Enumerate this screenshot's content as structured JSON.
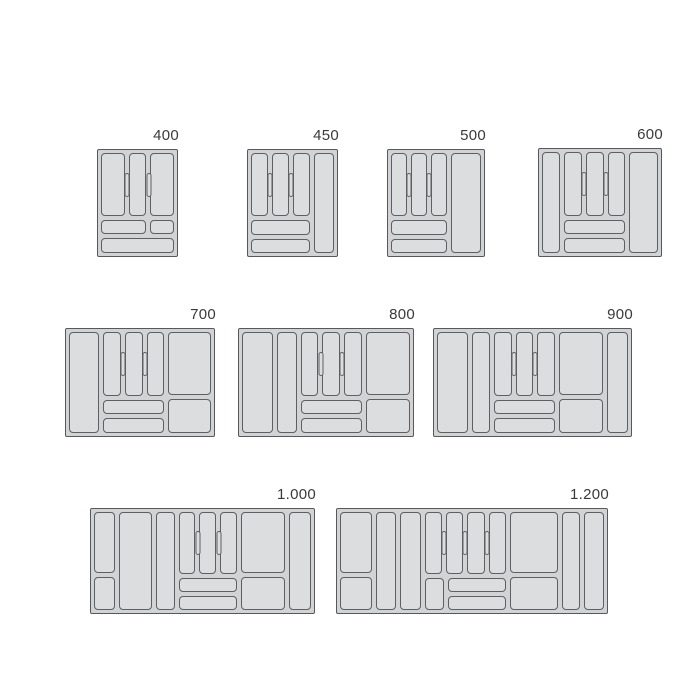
{
  "colors": {
    "background": "#ffffff",
    "tray_base": "#d2d3d5",
    "compartment_fill": "#dcddde",
    "outline": "#56585c",
    "compartment_outline": "#5d5f63",
    "label_text": "#3a3a3c"
  },
  "trays": [
    {
      "label": "400",
      "x": 97,
      "y": 149,
      "w": 81,
      "h": 108,
      "columns": [
        {
          "type": "cutlery",
          "flex": 69,
          "verticals": [
            23,
            17,
            23
          ],
          "pills": 2,
          "bottom": "split_then_full"
        }
      ]
    },
    {
      "label": "450",
      "x": 247,
      "y": 149,
      "w": 91,
      "h": 108,
      "columns": [
        {
          "type": "cutlery",
          "flex": 60,
          "verticals": [
            1,
            1,
            1
          ],
          "pills": 2,
          "bottom": "rows"
        },
        {
          "type": "tall",
          "flex": 20
        }
      ]
    },
    {
      "label": "500",
      "x": 387,
      "y": 149,
      "w": 98,
      "h": 108,
      "columns": [
        {
          "type": "cutlery",
          "flex": 55,
          "verticals": [
            1,
            1,
            1
          ],
          "pills": 2,
          "bottom": "rows"
        },
        {
          "type": "tall",
          "flex": 30
        }
      ]
    },
    {
      "label": "600",
      "x": 538,
      "y": 148,
      "w": 124,
      "h": 109,
      "columns": [
        {
          "type": "tall",
          "flex": 18
        },
        {
          "type": "cutlery",
          "flex": 60,
          "verticals": [
            1,
            1,
            1
          ],
          "pills": 2,
          "bottom": "rows"
        },
        {
          "type": "tall",
          "flex": 28
        }
      ]
    },
    {
      "label": "700",
      "x": 65,
      "y": 328,
      "w": 150,
      "h": 109,
      "columns": [
        {
          "type": "tall",
          "flex": 30
        },
        {
          "type": "cutlery",
          "flex": 60,
          "verticals": [
            1,
            1,
            1
          ],
          "pills": 2,
          "bottom": "rows"
        },
        {
          "type": "split",
          "flex": 42
        }
      ]
    },
    {
      "label": "800",
      "x": 238,
      "y": 328,
      "w": 176,
      "h": 109,
      "columns": [
        {
          "type": "tall",
          "flex": 30
        },
        {
          "type": "tall",
          "flex": 19
        },
        {
          "type": "cutlery",
          "flex": 59,
          "verticals": [
            1,
            1,
            1
          ],
          "pills": 2,
          "bottom": "rows"
        },
        {
          "type": "split",
          "flex": 43
        }
      ]
    },
    {
      "label": "900",
      "x": 433,
      "y": 328,
      "w": 199,
      "h": 109,
      "columns": [
        {
          "type": "tall",
          "flex": 30
        },
        {
          "type": "tall",
          "flex": 18
        },
        {
          "type": "cutlery",
          "flex": 60,
          "verticals": [
            1,
            1,
            1
          ],
          "pills": 2,
          "bottom": "rows"
        },
        {
          "type": "split",
          "flex": 43
        },
        {
          "type": "tall",
          "flex": 21
        }
      ]
    },
    {
      "label": "1.000",
      "x": 90,
      "y": 508,
      "w": 225,
      "h": 106,
      "columns": [
        {
          "type": "split",
          "flex": 21
        },
        {
          "type": "tall",
          "flex": 34
        },
        {
          "type": "tall",
          "flex": 19
        },
        {
          "type": "cutlery",
          "flex": 60,
          "verticals": [
            1,
            1,
            1
          ],
          "pills": 2,
          "bottom": "rows"
        },
        {
          "type": "split",
          "flex": 45
        },
        {
          "type": "tall",
          "flex": 22
        }
      ]
    },
    {
      "label": "1.200",
      "x": 336,
      "y": 508,
      "w": 272,
      "h": 106,
      "columns": [
        {
          "type": "split",
          "flex": 32
        },
        {
          "type": "tall",
          "flex": 20
        },
        {
          "type": "tall",
          "flex": 20
        },
        {
          "type": "cutlery",
          "flex": 81,
          "verticals": [
            1,
            1,
            1,
            1
          ],
          "pills": 3,
          "bottom": "square_rows"
        },
        {
          "type": "split",
          "flex": 47
        },
        {
          "type": "tall",
          "flex": 18
        },
        {
          "type": "tall",
          "flex": 20
        }
      ]
    }
  ]
}
